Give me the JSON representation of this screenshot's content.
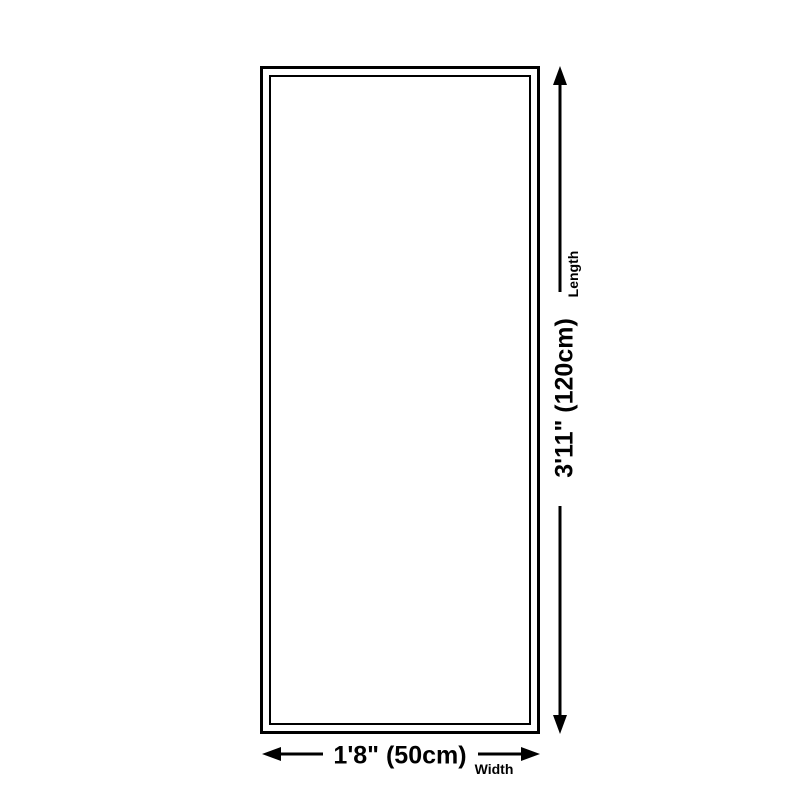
{
  "page": {
    "background": "#ffffff"
  },
  "colors": {
    "line": "#000000",
    "text": "#000000"
  },
  "diagram": {
    "shape": "rectangle",
    "dimensions": {
      "length": {
        "label": "Length",
        "value": "3'11\" (120cm)"
      },
      "width": {
        "label": "Width",
        "value": "1'8\" (50cm)"
      }
    }
  }
}
